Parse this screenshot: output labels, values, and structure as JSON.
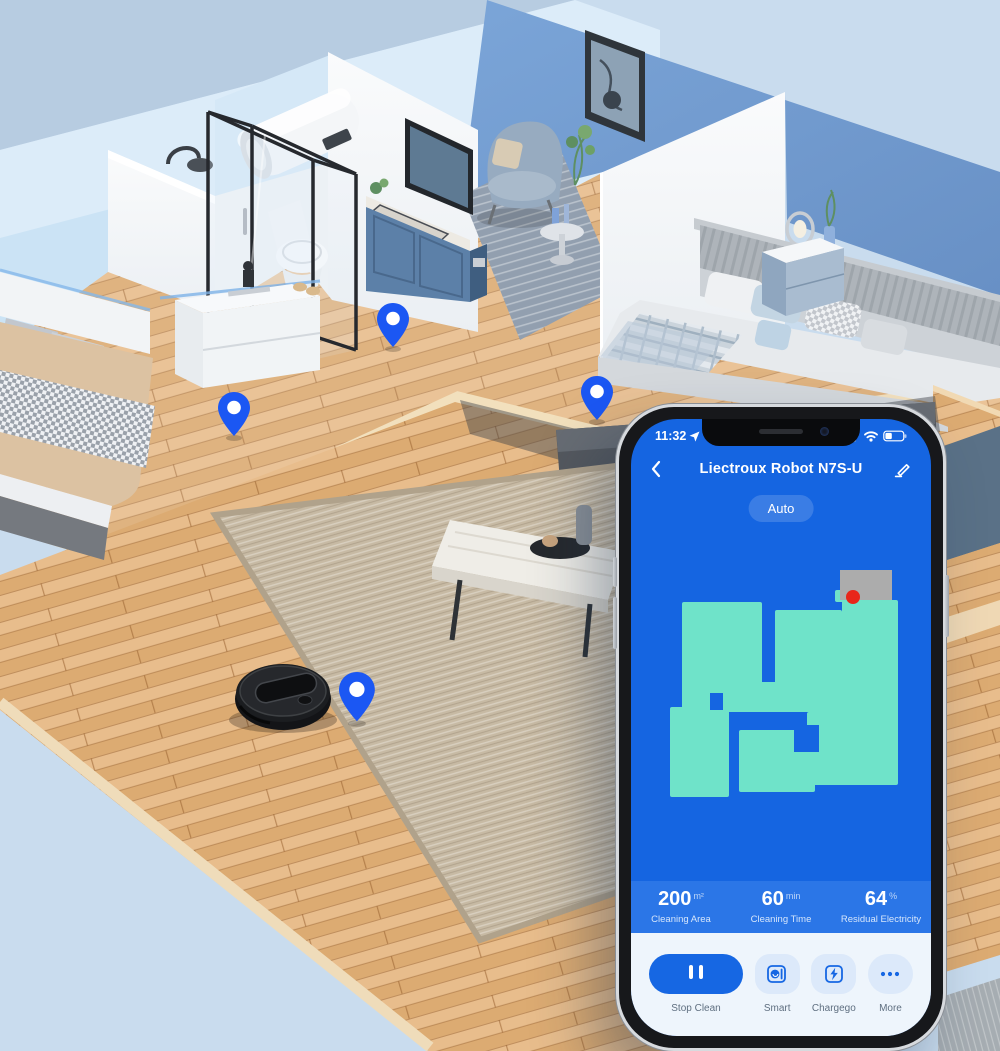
{
  "phone": {
    "status_bar": {
      "time": "11:32",
      "icons": [
        "location-arrow-icon",
        "cellular-signal-icon",
        "wifi-icon",
        "battery-icon"
      ]
    },
    "header": {
      "title": "Liectroux Robot N7S-U",
      "back_icon": "back-chevron-icon",
      "edit_icon": "edit-pen-icon"
    },
    "mode_pill": {
      "label": "Auto"
    },
    "map": {
      "background_color": "#1565E1",
      "cleaned_color": "#6FE3C9",
      "dock_color": "#ACACAC",
      "robot_color": "#E8261A",
      "cleaned_regions": [
        [
          51,
          87,
          80,
          107
        ],
        [
          144,
          95,
          67,
          84
        ],
        [
          211,
          85,
          56,
          182
        ],
        [
          51,
          167,
          216,
          30
        ],
        [
          39,
          192,
          59,
          90
        ],
        [
          108,
          215,
          76,
          62
        ],
        [
          176,
          197,
          91,
          73
        ],
        [
          204,
          75,
          10,
          12
        ]
      ],
      "holes": [
        [
          131,
          105,
          13,
          62
        ],
        [
          98,
          197,
          10,
          63
        ],
        [
          163,
          210,
          25,
          27
        ],
        [
          79,
          178,
          13,
          17
        ]
      ],
      "dock": [
        209,
        55,
        52,
        30
      ],
      "robot": {
        "x": 222,
        "y": 82,
        "r": 7
      }
    },
    "stats": [
      {
        "value": "200",
        "unit": "m²",
        "label": "Cleaning Area"
      },
      {
        "value": "60",
        "unit": "min",
        "label": "Cleaning Time"
      },
      {
        "value": "64",
        "unit": "%",
        "label": "Residual Electricity"
      }
    ],
    "actions": [
      {
        "label": "Stop Clean",
        "icon": "pause-icon"
      },
      {
        "label": "Smart",
        "icon": "smart-mode-icon"
      },
      {
        "label": "Chargego",
        "icon": "charge-bolt-icon"
      },
      {
        "label": "More",
        "icon": "more-dots-icon"
      }
    ],
    "colors": {
      "screen_blue": "#1565E1",
      "stats_band": "#2B76E7",
      "panel_bg": "#EEF5FC",
      "light_button": "#DCE9FA",
      "primary_button": "#1667E3",
      "label_gray": "#5F6F80"
    }
  },
  "scene": {
    "location_pins": {
      "count": 4,
      "color": "#1B57F3"
    },
    "robot_vacuum_color": "#1B1D20",
    "wood_color": "#E2B47E",
    "wall_blue": "#6C96CA"
  }
}
